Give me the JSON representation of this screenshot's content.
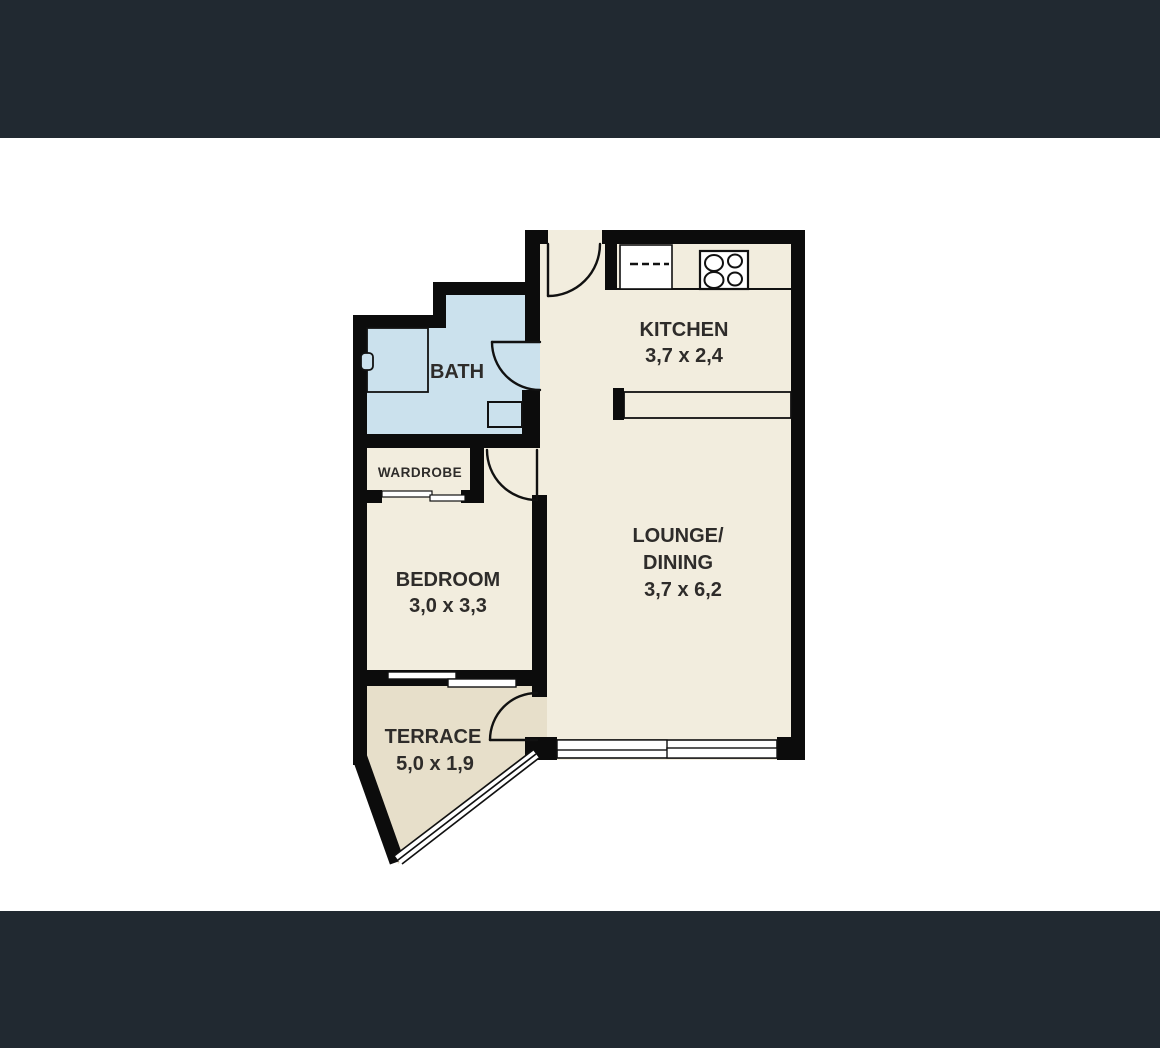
{
  "theme": {
    "top_bar_color": "#212931",
    "bottom_bar_color": "#212931",
    "background_color": "#ffffff",
    "wall_color": "#0c0c0c",
    "floor_color": "#f2edde",
    "terrace_floor_color": "#e7dfca",
    "bath_floor_color": "#cbe1ed",
    "fixture_fill_color": "#ffffff",
    "label_color": "#2e2c2a"
  },
  "floorplan": {
    "type": "apartment-floor-plan",
    "rooms": {
      "kitchen": {
        "label": "KITCHEN",
        "dimensions": "3,7 x 2,4"
      },
      "lounge_dining": {
        "label_line1": "LOUNGE/",
        "label_line2": "DINING",
        "dimensions": "3,7 x 6,2"
      },
      "bath": {
        "label": "BATH"
      },
      "wardrobe": {
        "label": "WARDROBE"
      },
      "bedroom": {
        "label": "BEDROOM",
        "dimensions": "3,0 x 3,3"
      },
      "terrace": {
        "label": "TERRACE",
        "dimensions": "5,0 x 1,9"
      }
    },
    "fixtures": [
      "stove-icon",
      "kitchen-counter",
      "kitchen-bench",
      "bathtub-icon",
      "vanity-icon",
      "wardrobe-sliding-door",
      "bedroom-window",
      "lounge-window",
      "terrace-railing",
      "entry-door",
      "bath-door",
      "bedroom-door",
      "terrace-door"
    ]
  }
}
